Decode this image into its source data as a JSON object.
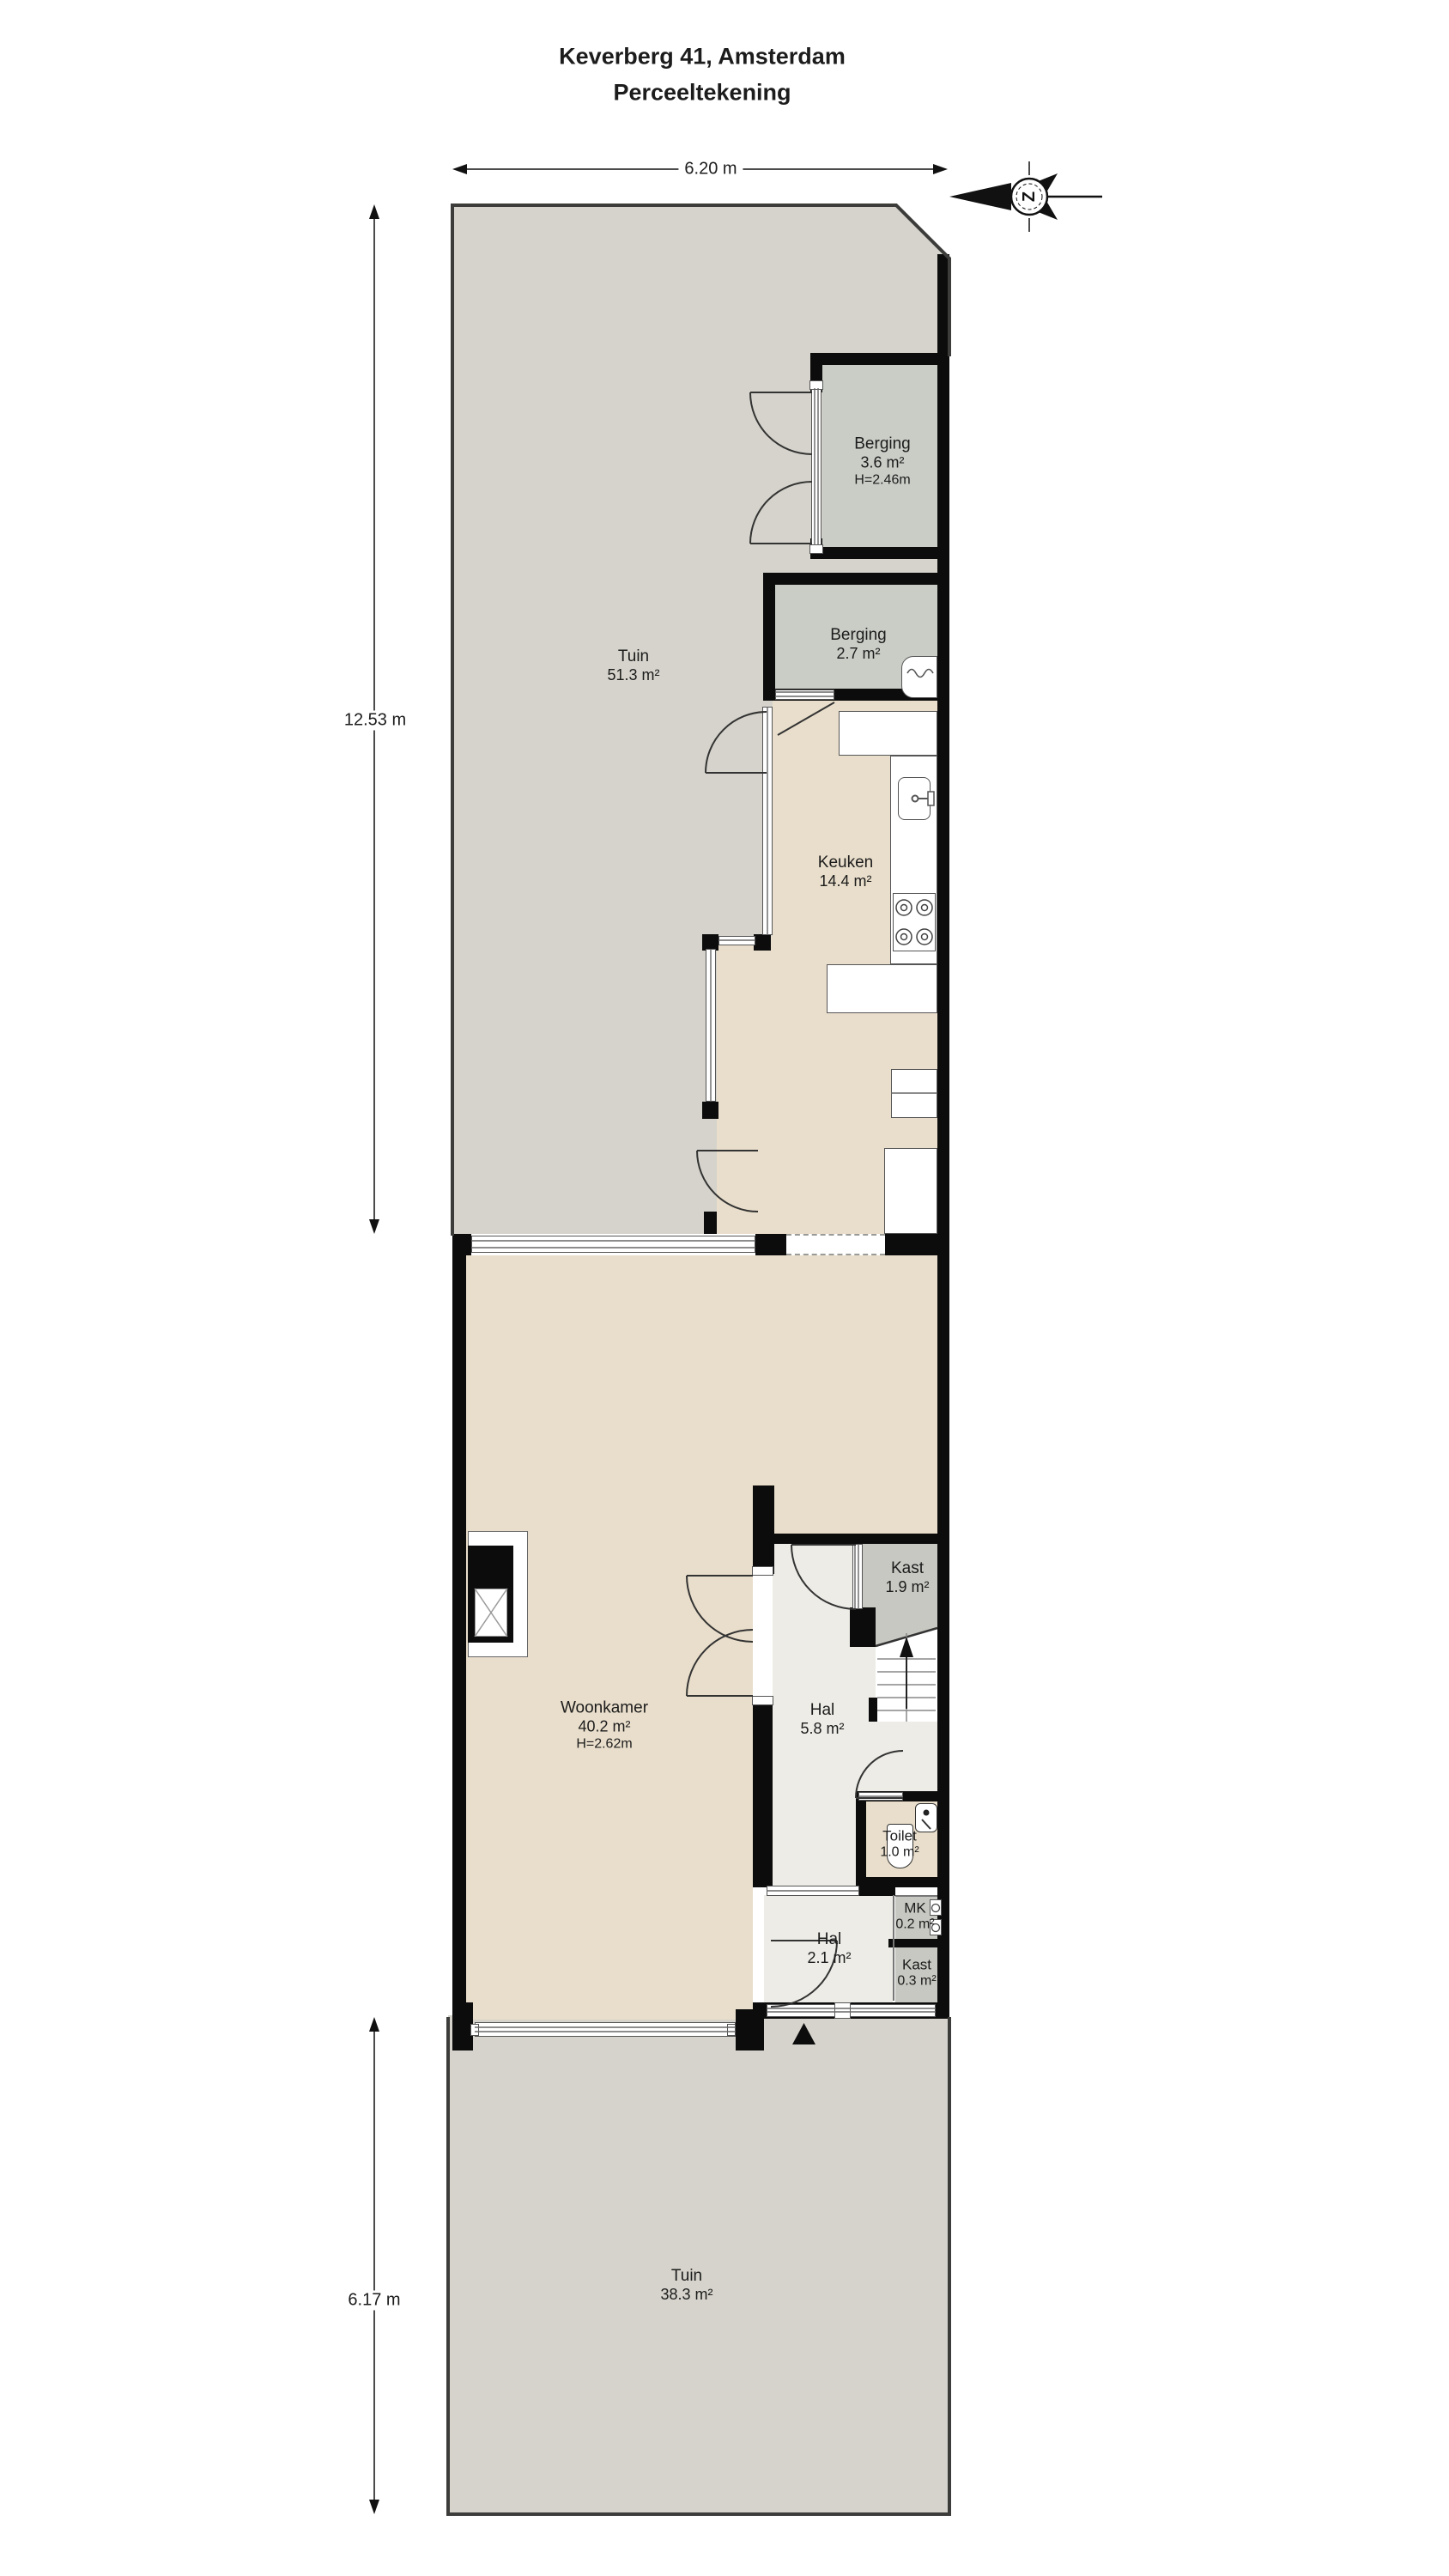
{
  "title": {
    "line1": "Keverberg 41, Amsterdam",
    "line2": "Perceeltekening"
  },
  "dimensions": {
    "top_width": "6.20 m",
    "back_depth": "12.53 m",
    "front_depth": "6.17 m"
  },
  "compass": {
    "letter": "Z"
  },
  "rooms": {
    "tuin_back": {
      "name": "Tuin",
      "area": "51.3 m²"
    },
    "berging_large": {
      "name": "Berging",
      "area": "3.6 m²",
      "height": "H=2.46m"
    },
    "berging_small": {
      "name": "Berging",
      "area": "2.7 m²"
    },
    "keuken": {
      "name": "Keuken",
      "area": "14.4 m²"
    },
    "woonkamer": {
      "name": "Woonkamer",
      "area": "40.2 m²",
      "height": "H=2.62m"
    },
    "kast": {
      "name": "Kast",
      "area": "1.9 m²"
    },
    "hal": {
      "name": "Hal",
      "area": "5.8 m²"
    },
    "toilet": {
      "name": "Toilet",
      "area": "1.0 m²"
    },
    "mk": {
      "name": "MK",
      "area": "0.2 m²"
    },
    "hal_entree": {
      "name": "Hal",
      "area": "2.1 m²"
    },
    "kast_klein": {
      "name": "Kast",
      "area": "0.3 m²"
    },
    "tuin_front": {
      "name": "Tuin",
      "area": "38.3 m²"
    }
  },
  "colors": {
    "garden": "#d5d3cb",
    "storage_room": "#c9cdc6",
    "living_room": "#e9decb",
    "hallway": "#edece7",
    "closet": "#c6c8c1",
    "wall": "#0c0c0c"
  }
}
